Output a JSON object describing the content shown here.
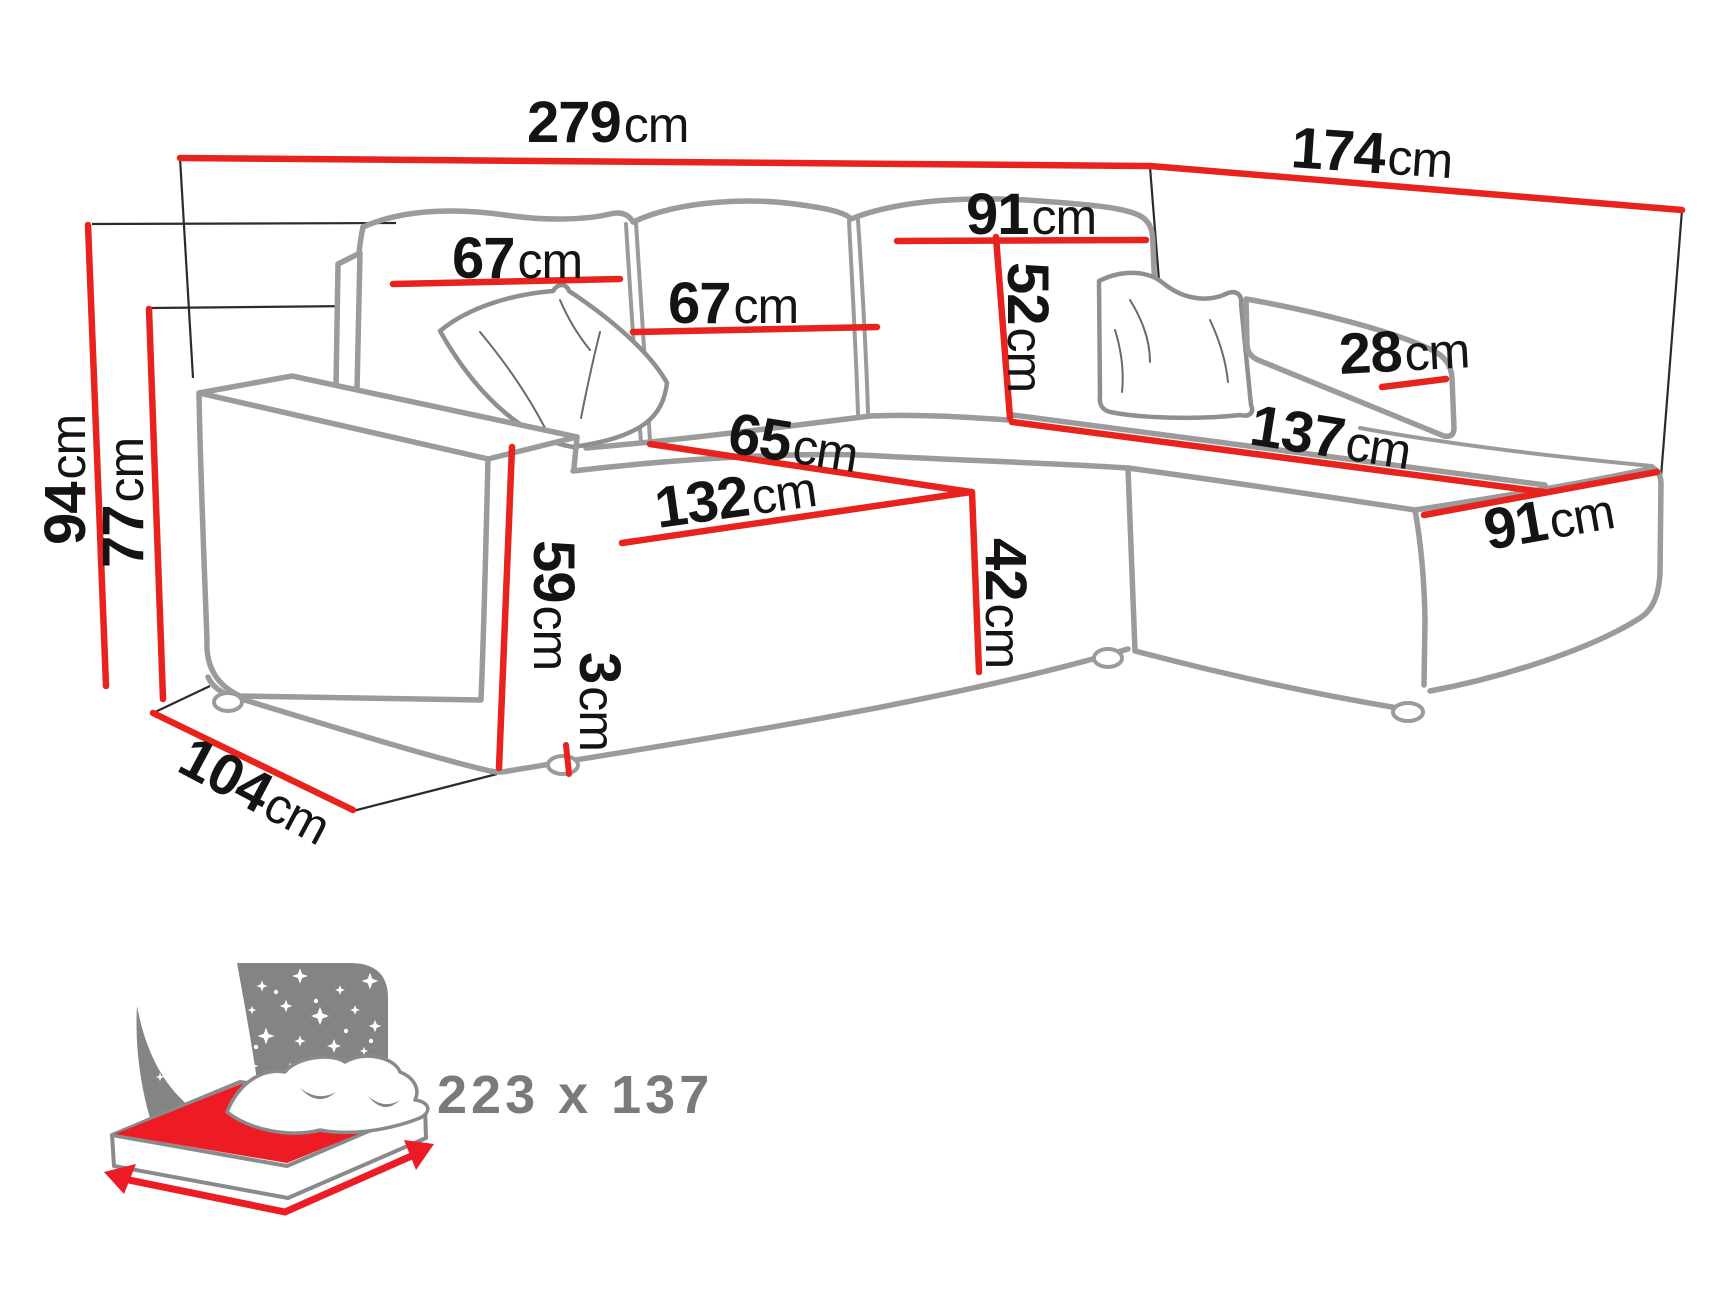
{
  "colors": {
    "dimension_line_red": "#e8221c",
    "sofa_outline_gray": "#9b9b9b",
    "label_black": "#141414",
    "bed_icon_gray": "#848484",
    "bed_icon_red": "#ed1c24",
    "bed_text_gray": "#7a7a7a"
  },
  "icons": {
    "sleeping_area_icon": "bed-with-starry-night-headboard"
  },
  "dimensions": {
    "total_width": {
      "value": "279",
      "unit": "cm"
    },
    "total_depth": {
      "value": "174",
      "unit": "cm"
    },
    "total_height": {
      "value": "94",
      "unit": "cm"
    },
    "backrest_height": {
      "value": "77",
      "unit": "cm"
    },
    "back_cushion_left": {
      "value": "67",
      "unit": "cm"
    },
    "back_cushion_mid": {
      "value": "67",
      "unit": "cm"
    },
    "corner_back_width": {
      "value": "91",
      "unit": "cm"
    },
    "corner_back_height": {
      "value": "52",
      "unit": "cm"
    },
    "small_armrest_width": {
      "value": "28",
      "unit": "cm"
    },
    "chaise_length": {
      "value": "137",
      "unit": "cm"
    },
    "chaise_end_width": {
      "value": "91",
      "unit": "cm"
    },
    "seat_depth": {
      "value": "65",
      "unit": "cm"
    },
    "seat_width": {
      "value": "132",
      "unit": "cm"
    },
    "seat_height": {
      "value": "42",
      "unit": "cm"
    },
    "armrest_height": {
      "value": "59",
      "unit": "cm"
    },
    "leg_height": {
      "value": "3",
      "unit": "cm"
    },
    "side_depth": {
      "value": "104",
      "unit": "cm"
    }
  },
  "sleeping_area": {
    "label": "223 x 137"
  }
}
